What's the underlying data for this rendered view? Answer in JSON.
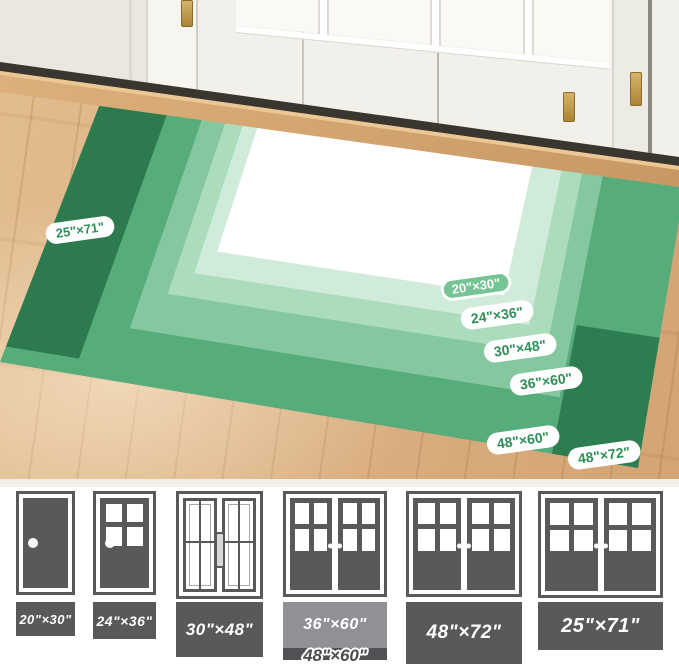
{
  "image_alt": "Doormat size comparison rug shown in front of white patio doors",
  "rug_overlay": {
    "size_labels": [
      {
        "text": "25\"×71\"",
        "variant": "white"
      },
      {
        "text": "20\"×30\"",
        "variant": "green"
      },
      {
        "text": "24\"×36\"",
        "variant": "white"
      },
      {
        "text": "30\"×48\"",
        "variant": "white"
      },
      {
        "text": "36\"×60\"",
        "variant": "white"
      },
      {
        "text": "48\"×60\"",
        "variant": "white"
      },
      {
        "text": "48\"×72\"",
        "variant": "white"
      }
    ],
    "mats": [
      {
        "size": "20\"×30\"",
        "color": "#ffffff"
      },
      {
        "size": "24\"×36\"",
        "color": "#d0ebda"
      },
      {
        "size": "30\"×48\"",
        "color": "#abdcbc"
      },
      {
        "size": "36\"×60\"",
        "color": "#85c8a0"
      },
      {
        "size": "48\"×60\"",
        "color": "#56ac7a"
      },
      {
        "size": "48\"×72\"",
        "color": "#2e7d50"
      },
      {
        "size": "25\"×71\"",
        "color": "#2c7a4e",
        "note": "runner"
      }
    ]
  },
  "size_chart": {
    "items": [
      {
        "size": "20\"×30\"",
        "door_type": "single-solid",
        "mat_style": "dark"
      },
      {
        "size": "24\"×36\"",
        "door_type": "single-window",
        "mat_style": "dark"
      },
      {
        "size": "30\"×48\"",
        "door_type": "french-double",
        "mat_style": "dark"
      },
      {
        "size": "36\"×60\"",
        "door_type": "sliding-double",
        "mat_style": "light",
        "behind_size": "48\"×60\""
      },
      {
        "size": "48\"×72\"",
        "door_type": "sliding-double",
        "mat_style": "dark"
      },
      {
        "size": "25\"×71\"",
        "door_type": "sliding-double",
        "mat_style": "dark"
      }
    ]
  },
  "colors": {
    "rug_dark": "#2e7d50",
    "rug_runner": "#2c7a4e",
    "rug_medium": "#56ac7a",
    "rug_band_36x60": "#85c8a0",
    "rug_band_30x48": "#abdcbc",
    "rug_band_24x36": "#d0ebda",
    "rug_center": "#ffffff",
    "pill_text_green": "#2f8f58",
    "pill_solid_bg": "#74c494",
    "door_gray": "#58595b",
    "mat_light_gray": "#8f9194",
    "mat_strip_gray": "#515256",
    "outline_text_gray": "#4b4c4e",
    "wood_floor": "#dbb083",
    "wall_white": "#f1f0ea"
  }
}
